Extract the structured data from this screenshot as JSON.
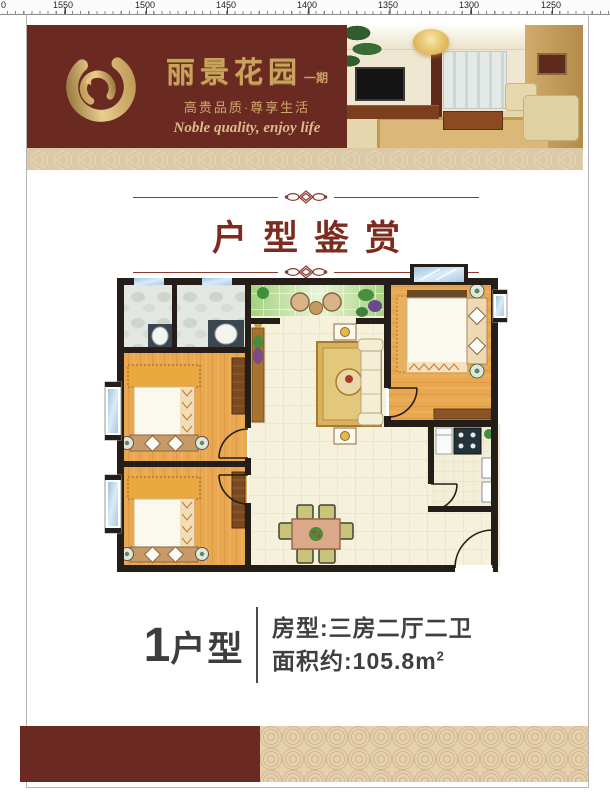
{
  "ruler": {
    "labels": [
      "0",
      "1550",
      "1500",
      "1450",
      "1400",
      "1350",
      "1300",
      "1250"
    ]
  },
  "header": {
    "brand_title": "丽景花园",
    "brand_phase": "一期",
    "slogan_cn": "高贵品质·尊享生活",
    "slogan_en": "Noble quality, enjoy life"
  },
  "section": {
    "title": "户型鉴赏"
  },
  "unit": {
    "number": "1",
    "type_suffix": "户型",
    "rooms": "房型:三房二厅二卫",
    "area_prefix": "面积约:105.8m",
    "area_exponent": "2"
  },
  "colors": {
    "maroon": "#6b2a21",
    "gold": "#c9a25e",
    "title_red": "#7d2b1e",
    "text_dark": "#3d3d3d",
    "wall": "#241d18",
    "wood_floor": "#e9a84f",
    "tile_floor": "#f5f1da",
    "balcony_green": "#cde8b4",
    "window_blue": "#b9d3e8",
    "strip_beige": "#dcc9a7"
  }
}
